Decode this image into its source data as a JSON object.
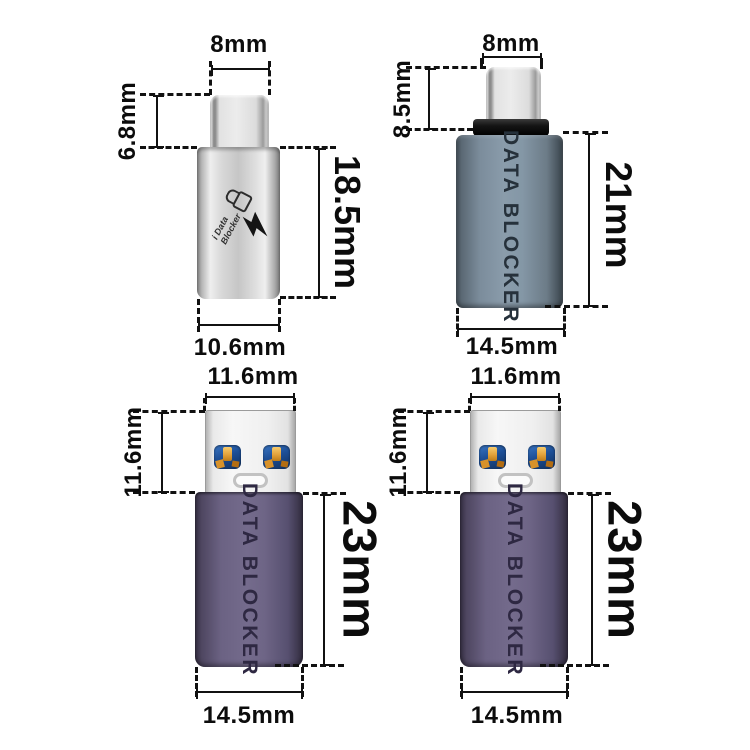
{
  "adapters": {
    "top_left": {
      "dim_top": "8mm",
      "dim_left": "6.8mm",
      "dim_right": "18.5mm",
      "dim_bottom": "10.6mm",
      "logo": {
        "line1": "i Data",
        "line2": "Blocker",
        "icons": [
          "padlock-icon",
          "lightning-bolt-icon"
        ]
      }
    },
    "top_right": {
      "dim_top": "8mm",
      "dim_left": "8.5mm",
      "dim_right": "21mm",
      "dim_bottom": "14.5mm",
      "body_text": "DATA BLOCKER"
    },
    "bottom_left": {
      "dim_top": "11.6mm",
      "dim_left": "11.6mm",
      "dim_right": "23mm",
      "dim_bottom": "14.5mm",
      "body_text": "DATA BLOCKER"
    },
    "bottom_right": {
      "dim_top": "11.6mm",
      "dim_left": "11.6mm",
      "dim_right": "23mm",
      "dim_bottom": "14.5mm",
      "body_text": "DATA BLOCKER"
    }
  },
  "colors": {
    "background": "#ffffff",
    "dimension_ink": "#111111",
    "silver_body": "#d6d6d6",
    "slate_body": "#8496a5",
    "purple_body": "#6e6586",
    "collar_black": "#161616",
    "usb_pin_blue": "#1d4f97",
    "usb_pin_orange": "#e3a23a"
  }
}
